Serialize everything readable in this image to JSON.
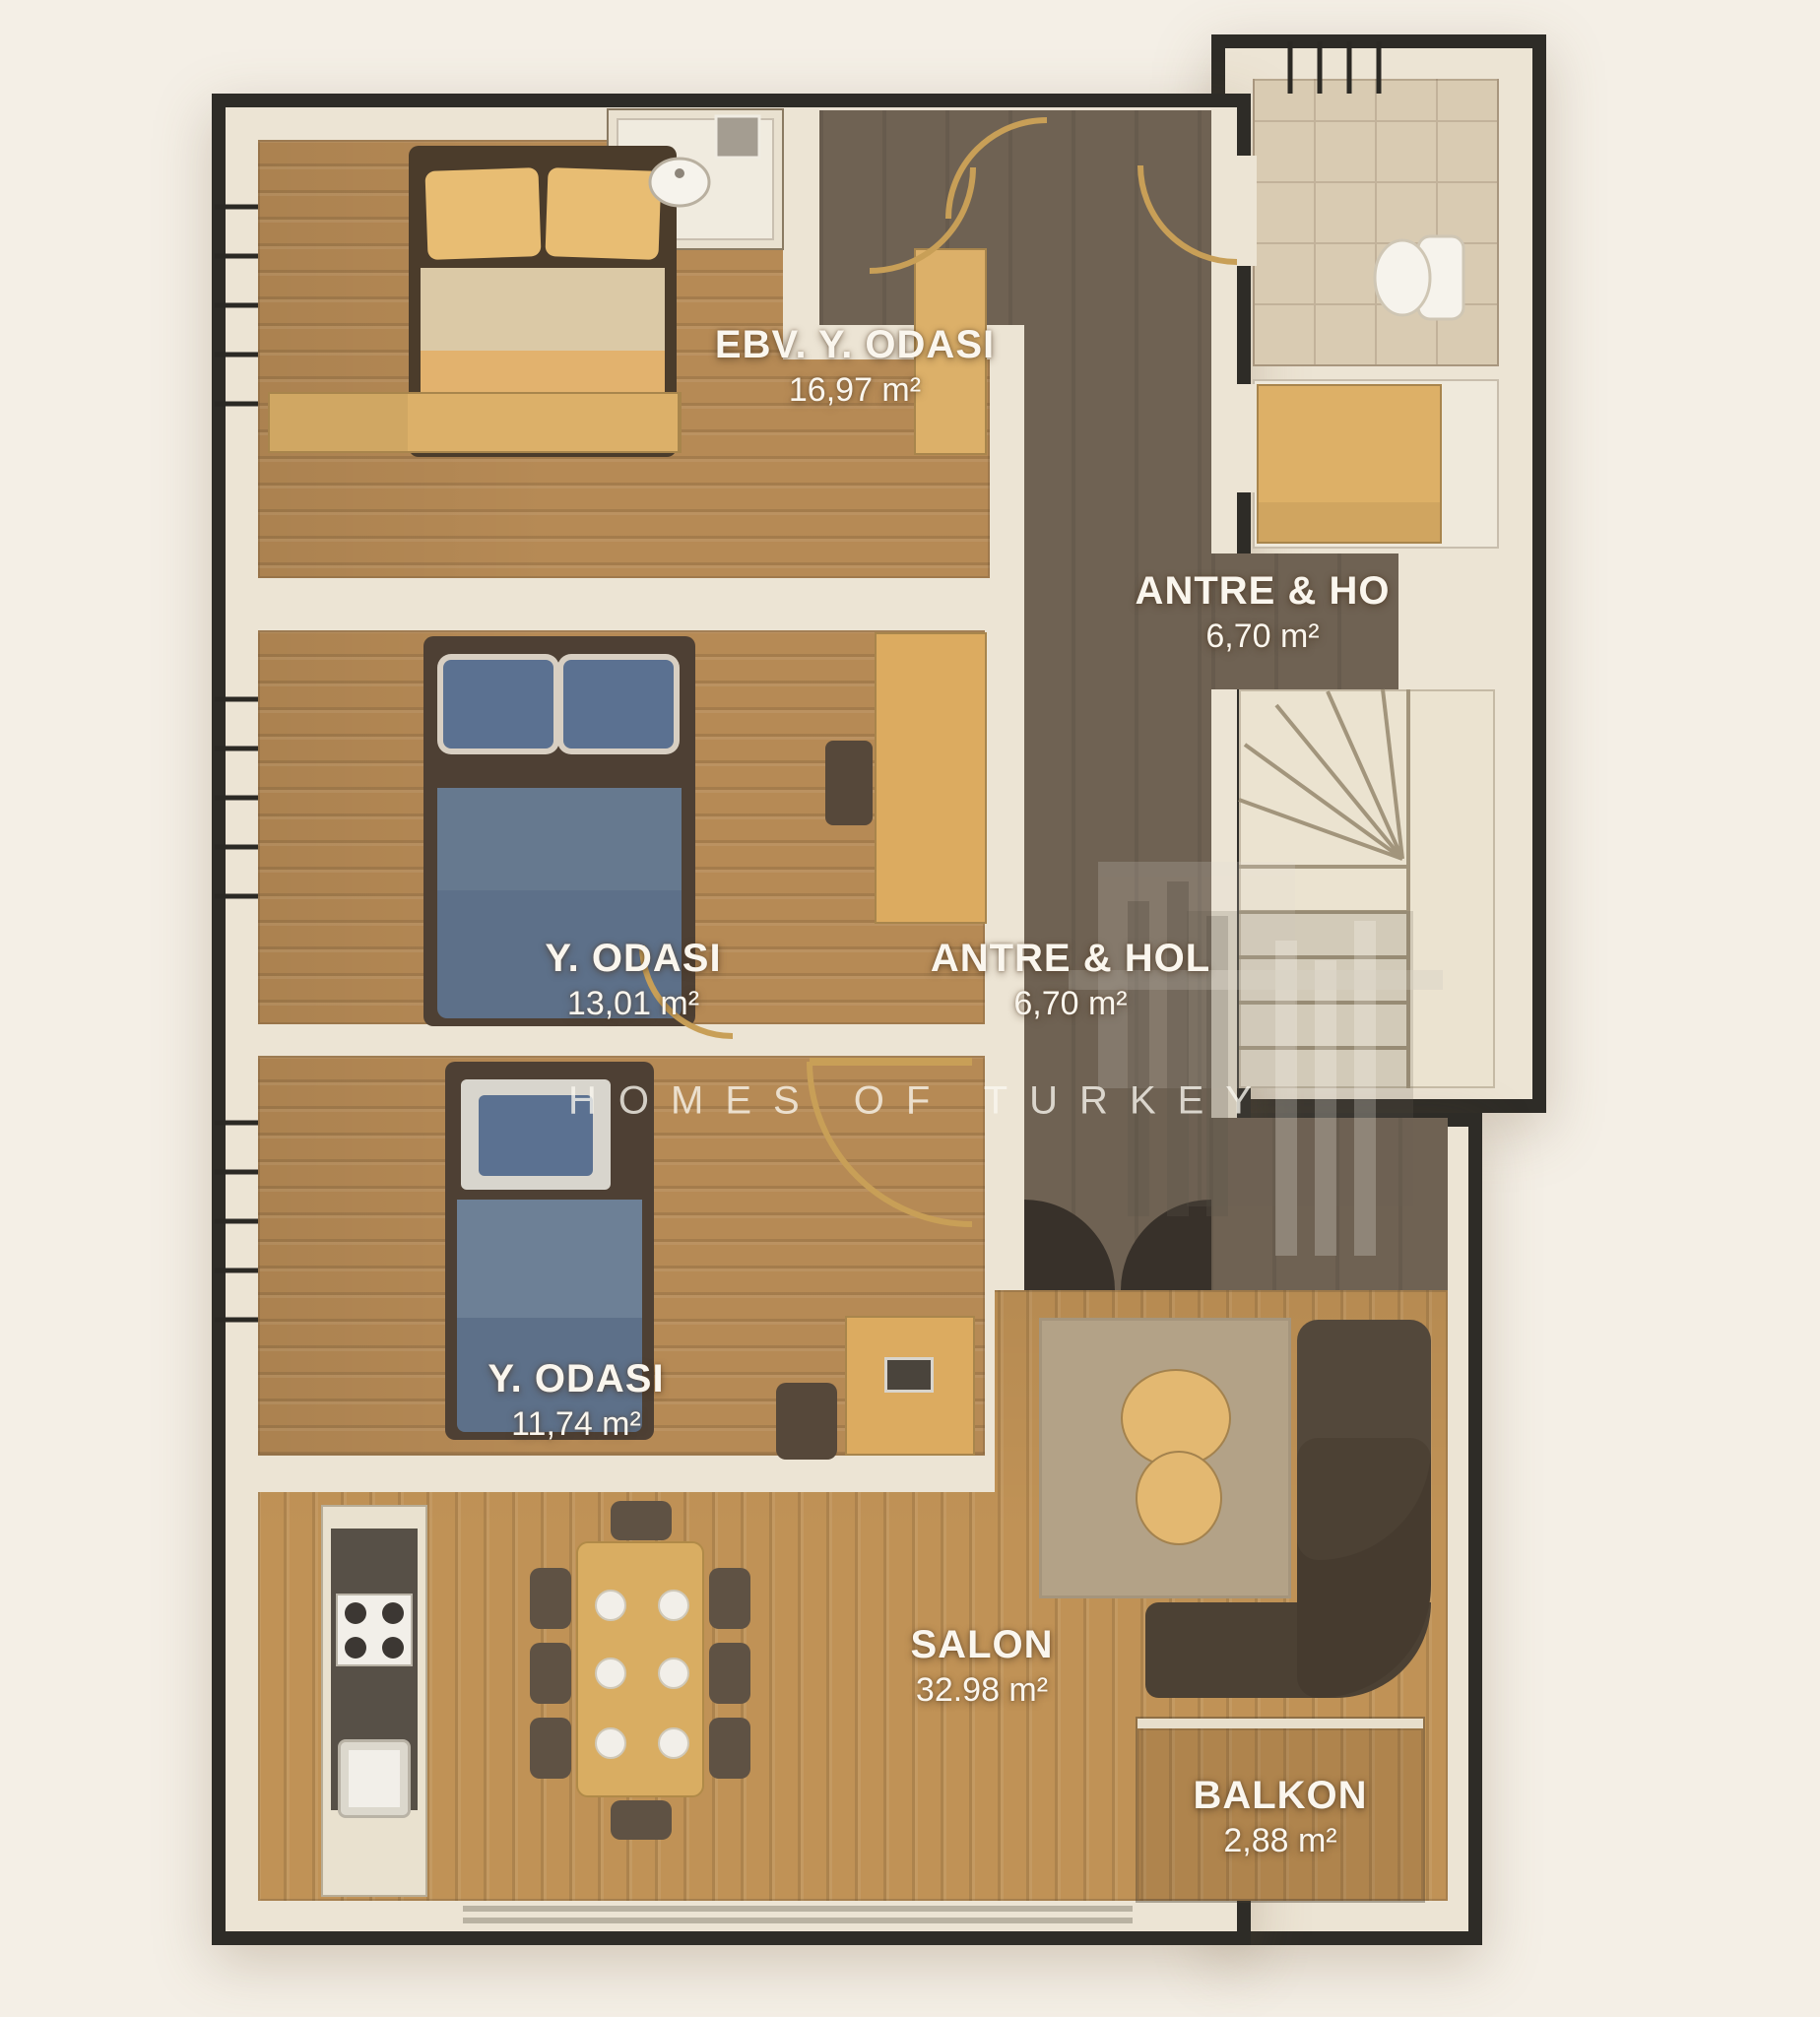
{
  "watermark": {
    "brand": "HOMES OF TURKEY"
  },
  "rooms": [
    {
      "name": "EBV. Y. ODASI",
      "area": "16,97 m²"
    },
    {
      "name": "ANTRE & HO",
      "area": "6,70 m²"
    },
    {
      "name": "Y. ODASI",
      "area": "13,01 m²"
    },
    {
      "name": "ANTRE & HOL",
      "area": "6,70 m²"
    },
    {
      "name": "Y. ODASI",
      "area": "11,74 m²"
    },
    {
      "name": "SALON",
      "area": "32.98 m²"
    },
    {
      "name": "BALKON",
      "area": "2,88 m²"
    }
  ],
  "palette": {
    "background": "#f4efe6",
    "wall_fill": "#ece4d4",
    "wall_outline": "#2e2c27",
    "wood_floor": "#b68a55",
    "salon_floor": "#c09256",
    "hall_floor": "#6f6253",
    "tile_floor": "#d9cbb2",
    "bed_blue": "#5d7089",
    "bed_tan": "#e2b26e",
    "sofa_brown": "#4c4134",
    "door_accent": "#c89f57",
    "label_text": "#faf6ee"
  }
}
